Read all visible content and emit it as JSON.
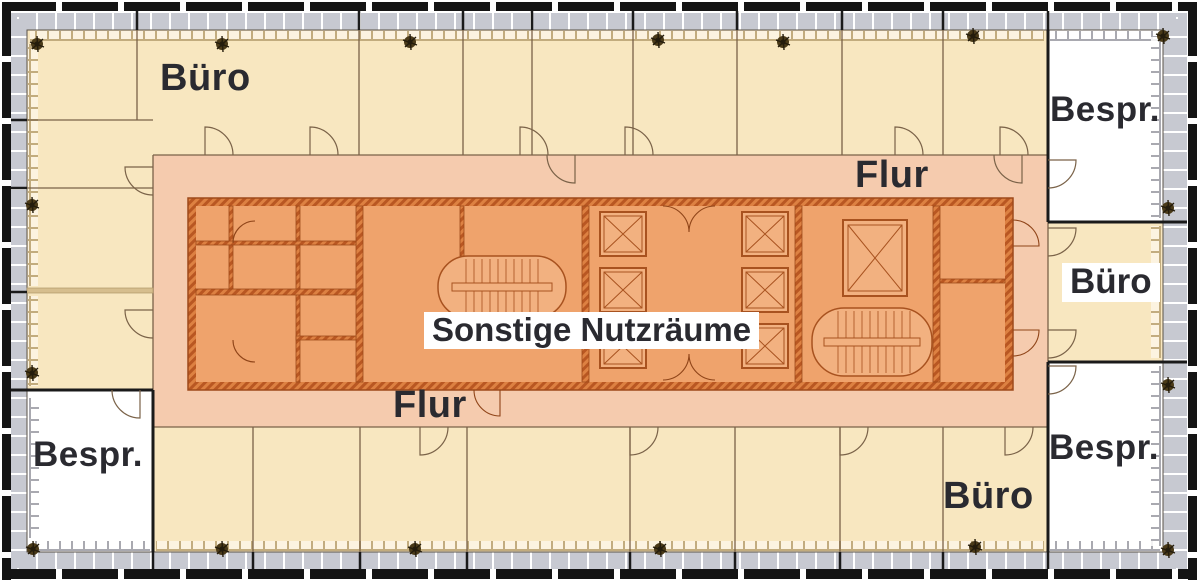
{
  "figure": {
    "kind": "building-floor-plan",
    "language": "de"
  },
  "zones": {
    "office": {
      "label": "Büro",
      "fill": "#F8E7C0"
    },
    "meeting": {
      "label": "Bespr.",
      "fill": "#FFFFFF"
    },
    "corridor": {
      "label": "Flur",
      "fill": "#F5CBAE"
    },
    "core": {
      "label": "Sonstige Nutzräume",
      "fill": "#EFA36C"
    }
  },
  "labels": {
    "buero_top_left": "Büro",
    "bespr_top_right": "Bespr.",
    "flur_top": "Flur",
    "buero_right": "Büro",
    "core": "Sonstige Nutzräume",
    "flur_bottom": "Flur",
    "bespr_bottom_left": "Bespr.",
    "buero_bottom": "Büro",
    "bespr_bottom_right": "Bespr."
  },
  "colors": {
    "outline": "#141414",
    "facade_band": "#C7C9D1",
    "office_fill": "#F8E7C0",
    "meeting_fill": "#FFFFFF",
    "corridor_fill": "#F5CBAE",
    "core_fill": "#EFA36C",
    "core_wall": "#B95722",
    "wall_line": "#7A6248",
    "label_text": "#2A2A30"
  },
  "icons": {
    "plant": "plant-icon",
    "stair": "stair-icon",
    "elevator": "elevator-icon",
    "door": "door-arc-icon"
  }
}
